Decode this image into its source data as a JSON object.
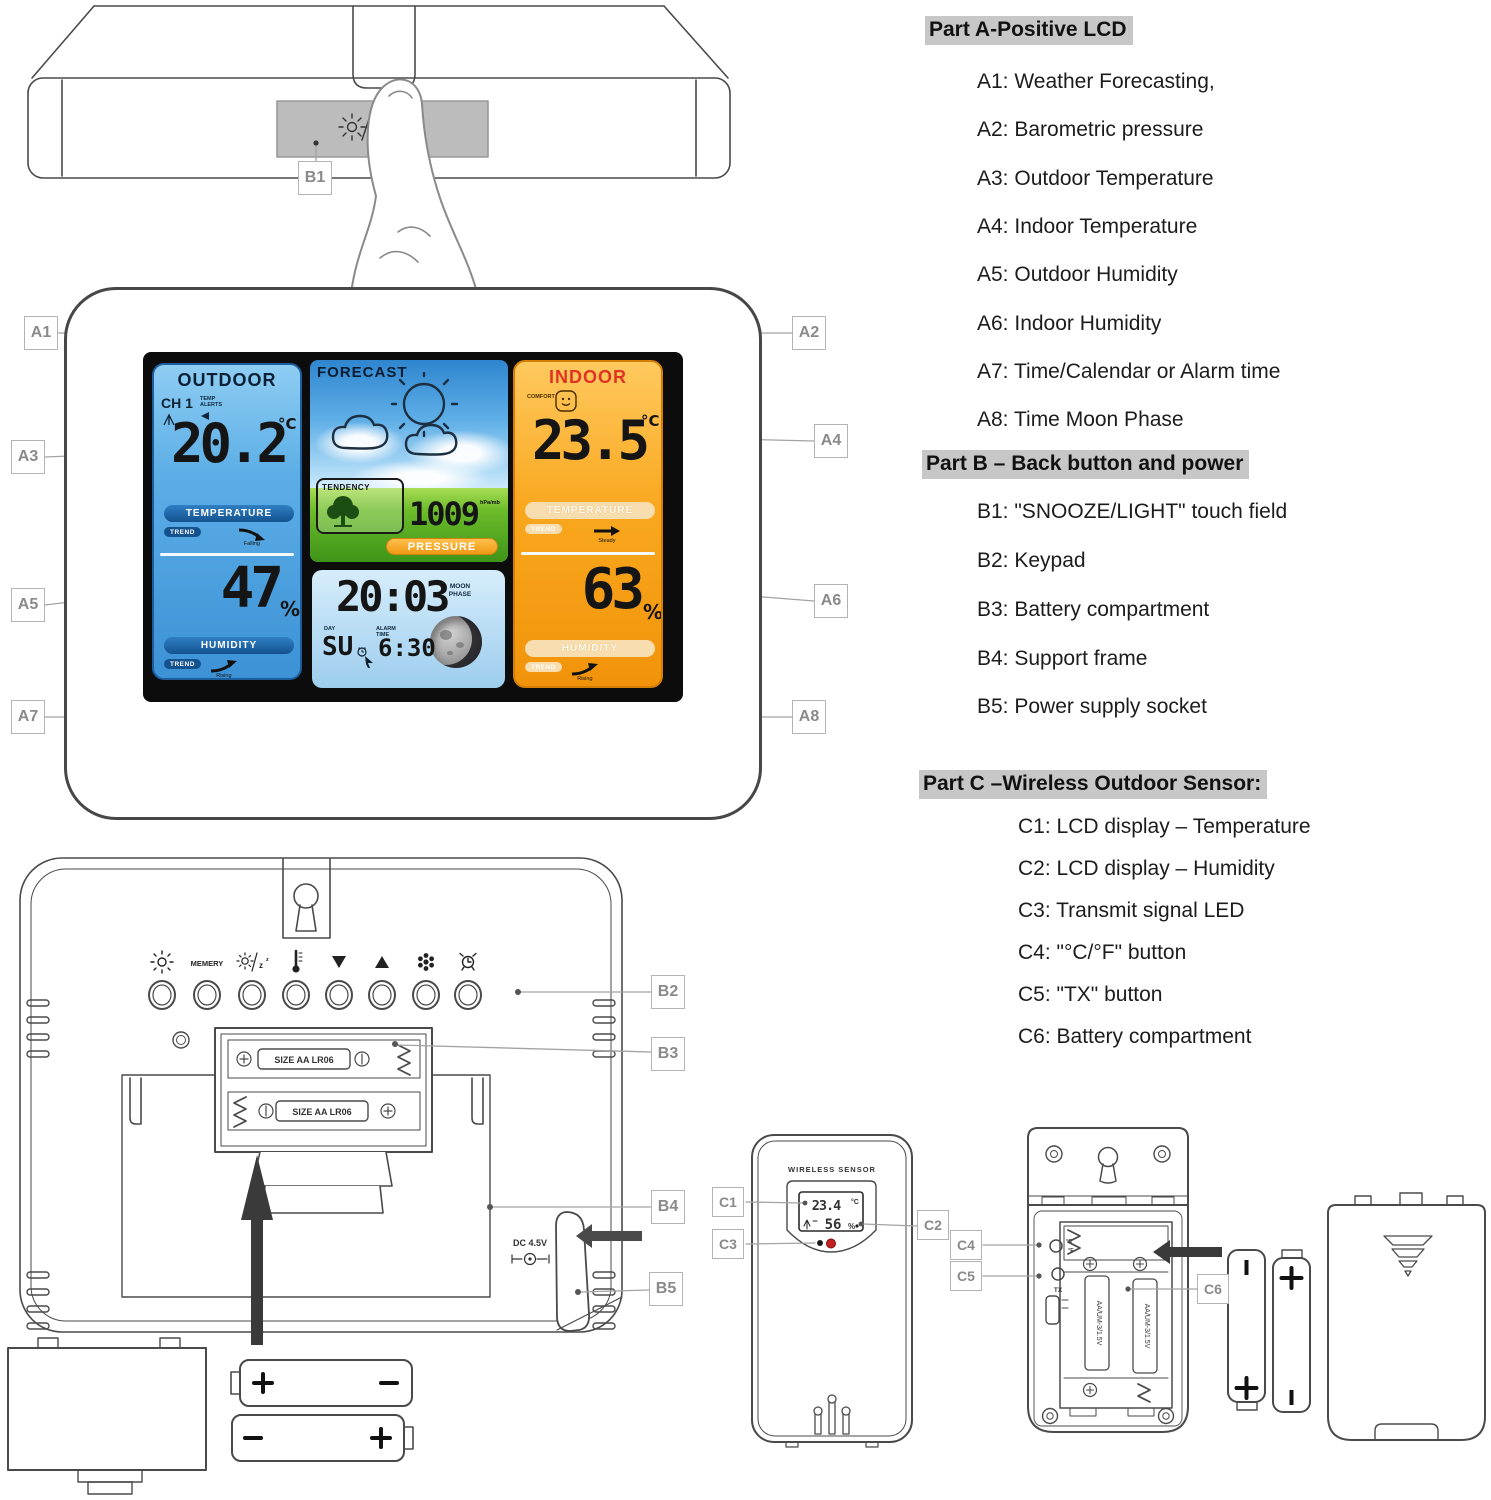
{
  "labels": {
    "a1": "A1",
    "a2": "A2",
    "a3": "A3",
    "a4": "A4",
    "a5": "A5",
    "a6": "A6",
    "a7": "A7",
    "a8": "A8",
    "b1": "B1",
    "b2": "B2",
    "b3": "B3",
    "b4": "B4",
    "b5": "B5",
    "c1": "C1",
    "c2": "C2",
    "c3": "C3",
    "c4": "C4",
    "c5": "C5",
    "c6": "C6"
  },
  "legend": {
    "part_a": {
      "heading": "Part A-Positive LCD",
      "items": [
        "A1: Weather Forecasting,",
        "A2: Barometric pressure",
        "A3: Outdoor Temperature",
        "A4: Indoor Temperature",
        "A5: Outdoor Humidity",
        "A6: Indoor Humidity",
        "A7: Time/Calendar or Alarm time",
        "A8: Time Moon Phase"
      ]
    },
    "part_b": {
      "heading": "Part B – Back button and power",
      "items": [
        "B1: \"SNOOZE/LIGHT\" touch field",
        "B2: Keypad",
        "B3: Battery compartment",
        "B4: Support frame",
        "B5: Power supply socket"
      ]
    },
    "part_c": {
      "heading": "Part C –Wireless Outdoor Sensor:",
      "items": [
        "C1: LCD display – Temperature",
        "C2: LCD display – Humidity",
        "C3: Transmit signal LED",
        "C4: \"°C/°F\" button",
        "C5: \"TX\" button",
        "C6: Battery compartment"
      ]
    }
  },
  "station": {
    "outdoor": {
      "title": "OUTDOOR",
      "channel": "CH 1",
      "alert_label": "TEMP ALERTS",
      "temperature": "20.2",
      "temp_unit": "°C",
      "temperature_banner": "TEMPERATURE",
      "trend_label": "TREND",
      "temp_trend": "Falling",
      "humidity": "47",
      "humidity_unit": "%",
      "humidity_banner": "HUMIDITY",
      "humidity_trend": "Rising"
    },
    "forecast": {
      "title": "FORECAST",
      "tendency_label": "TENDENCY",
      "pressure_value": "1009",
      "pressure_unit": "hPa/mb",
      "pressure_banner": "PRESSURE"
    },
    "clock": {
      "time": "20:03",
      "day_label": "DAY",
      "day": "SU",
      "alarm_label": "ALARM TIME",
      "alarm_time": "6:30",
      "moon_label": "MOON PHASE"
    },
    "indoor": {
      "title": "INDOOR",
      "comfort_label": "COMFORT",
      "temperature": "23.5",
      "temp_unit": "°C",
      "temperature_banner": "TEMPERATURE",
      "trend_label": "TREND",
      "temp_trend": "Steady",
      "humidity": "63",
      "humidity_unit": "%",
      "humidity_banner": "HUMIDITY",
      "humidity_trend": "Rising"
    }
  },
  "back": {
    "memory_button": "MEMERY",
    "battery_slot_label": "SIZE AA LR06",
    "dc_label": "DC 4.5V"
  },
  "sensor": {
    "title": "WIRELESS SENSOR",
    "temperature": "23.4",
    "temp_unit": "°C",
    "humidity": "56",
    "humidity_unit": "%",
    "battery_label": "AA/UM-3/1.5V",
    "cf_c": "°C",
    "cf_f": "°F",
    "tx_button": "TX"
  }
}
